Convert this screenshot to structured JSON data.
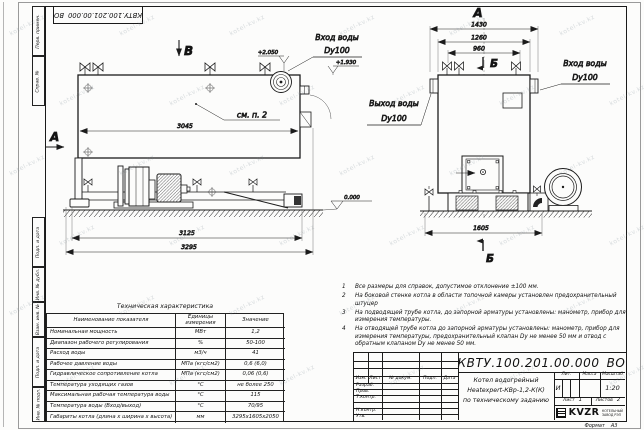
{
  "watermark": "kotel-kv.kz",
  "stamp": {
    "number": "КВТУ.100.201.00.000",
    "suffix": "ВО"
  },
  "frame": {
    "labels": {
      "perv": "Перв. примен.",
      "sprav": "Справ. №",
      "podp1": "Подп. и дата",
      "inv_dubl": "Инв. № дубл.",
      "vzam": "Взам. инв. №",
      "podp2": "Подп. и дата",
      "inv_podl": "Инв. № подл."
    },
    "format_label": "Формат",
    "format_value": "А3"
  },
  "drawing": {
    "side_view": {
      "view_b": "В",
      "view_a": "А",
      "see_note": "см. п. 2",
      "dim_3045": "3045",
      "dim_3125": "3125",
      "dim_3295": "3295",
      "inlet": "Вход воды",
      "inlet_dn": "Dy100",
      "lvl_inlet": "+2.050",
      "lvl_nozzle": "+1.930",
      "lvl_ground": "0.000"
    },
    "front_view": {
      "view_a": "А",
      "section_top": "Б",
      "section_bottom": "Б",
      "dim_1430": "1430",
      "dim_1260": "1260",
      "dim_960": "960",
      "dim_1605": "1605",
      "inlet": "Вход воды",
      "inlet_dn": "Dy100",
      "outlet": "Выход воды",
      "outlet_dn": "Dy100"
    }
  },
  "tech_table": {
    "title": "Техническая характеристика",
    "headers": [
      "Наименование показателя",
      "Единицы измерения",
      "Значение"
    ],
    "rows": [
      [
        "Номинальная мощность",
        "МВт",
        "1,2"
      ],
      [
        "Диапазон рабочего регулирования",
        "%",
        "50-100"
      ],
      [
        "Расход воды",
        "м3/ч",
        "41"
      ],
      [
        "Рабочее давление воды",
        "МПа (кгс/см2)",
        "0,6 (6,0)"
      ],
      [
        "Гидравлическое сопротивление котла",
        "МПа (кгс/см2)",
        "0,06 (0,6)"
      ],
      [
        "Температура уходящих газов",
        "°С",
        "не более 250"
      ],
      [
        "Максимальная рабочая температура воды",
        "°С",
        "115"
      ],
      [
        "Температура воды (Вход/выход)",
        "°С",
        "70/95"
      ],
      [
        "Габариты котла (длина х ширина х высота)",
        "мм",
        "3295х1605х2050"
      ]
    ]
  },
  "notes": [
    {
      "n": "1",
      "t": "Все размеры для справок, допустимое отклонение ±100 мм."
    },
    {
      "n": "2",
      "t": "На боковой стенке котла в области топочной камеры установлен предохранительный штуцер"
    },
    {
      "n": "3",
      "t": "На подводящей трубе котла, до запорной арматуры установлены: манометр, прибор для измерения температуры."
    },
    {
      "n": "4",
      "t": "На отводящей трубе котла до запорной арматуры установлены: манометр, прибор для измерения температуры, предохранительный клапан Dy не менее 50 мм и отвод с обратным клапаном Dy не менее 50 мм."
    }
  ],
  "title_block": {
    "doc_number": "КВТУ.100.201.00.000",
    "doc_suffix": "ВО",
    "cols": [
      "Изм.",
      "Лист",
      "№ докум.",
      "Подп.",
      "Дата"
    ],
    "rows": [
      "Разраб.",
      "Пров.",
      "Т.контр.",
      "Н.контр.",
      "Утв."
    ],
    "desc1": "Котел водогрейный",
    "desc2": "Heatexpert-КВр-1,2-К(К)",
    "desc3": "по техническому заданию",
    "lit": "Лит.",
    "mass": "Масса",
    "scale_lbl": "Масштаб",
    "lit_value": "И",
    "scale_value": "1:20",
    "sheet_lbl": "Лист",
    "sheet_no": "1",
    "sheets_lbl": "Листов",
    "sheets_no": "2",
    "brand": "KVZR",
    "brand_line1": "КОТЕЛЬНЫЙ",
    "brand_line2": "ЗАВОД РЭП"
  }
}
